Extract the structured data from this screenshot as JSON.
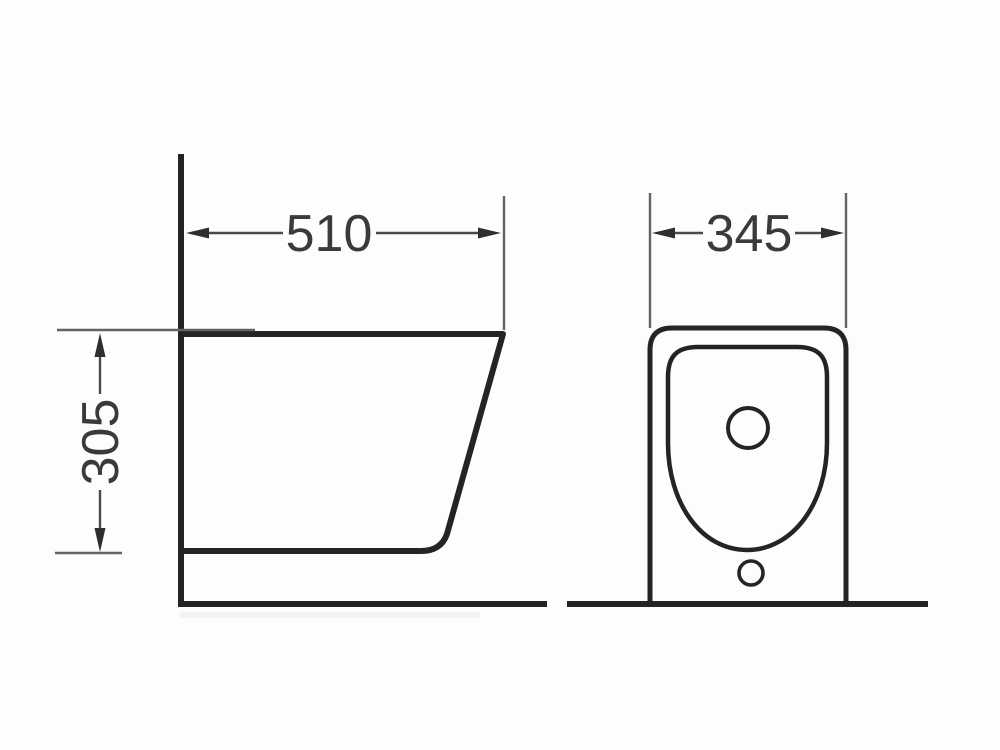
{
  "drawing": {
    "dimensions": {
      "side_width": "510",
      "side_height": "305",
      "front_width": "345"
    },
    "colors": {
      "outline": "#242424",
      "extension_line": "#636363",
      "dimension_line": "#4a4a4a",
      "arrowhead": "#2e2e2e",
      "text": "#3a3a3a",
      "background": "#fdfdfd"
    }
  }
}
